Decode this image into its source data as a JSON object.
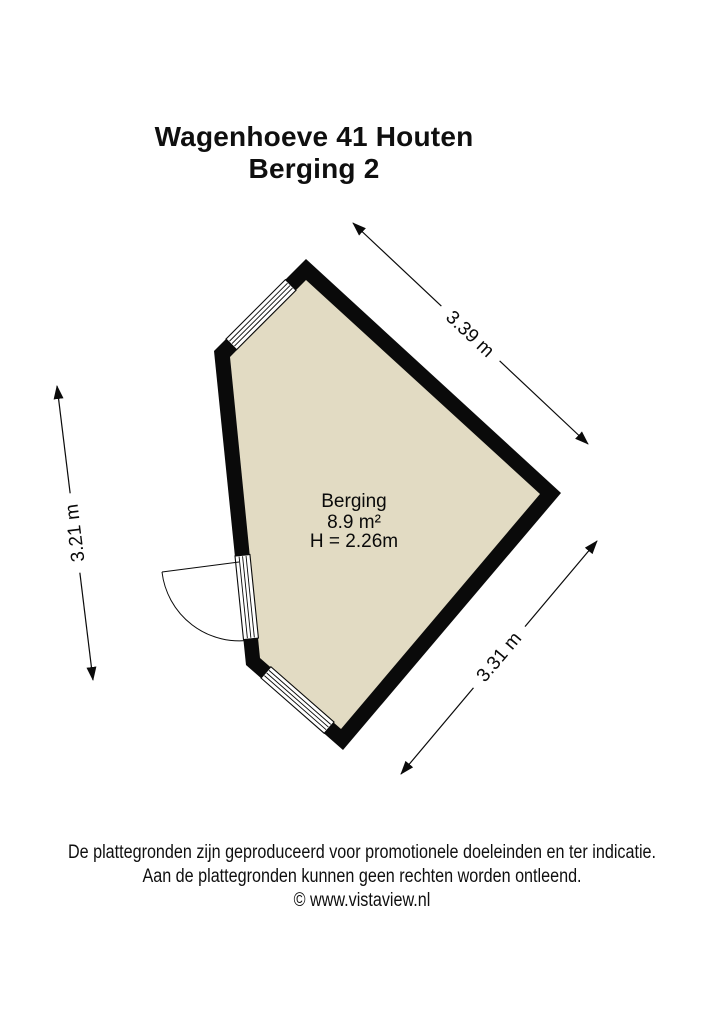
{
  "title": {
    "line1": "Wagenhoeve 41 Houten",
    "line2": "Berging 2"
  },
  "room": {
    "name": "Berging",
    "area": "8.9 m²",
    "ceiling_height": "H = 2.26m"
  },
  "dimensions": {
    "top_right": "3.39 m",
    "left": "3.21 m",
    "bottom_right": "3.31 m"
  },
  "footer": {
    "line1": "De plattegronden zijn geproduceerd voor promotionele doeleinden en ter indicatie.",
    "line2": "Aan de plattegronden kunnen geen rechten worden ontleend.",
    "line3": "© www.vistaview.nl"
  },
  "colors": {
    "wall": "#0a0a0a",
    "floor": "#e2dbc3",
    "window": "#ffffff",
    "line": "#0a0a0a",
    "background": "#ffffff"
  }
}
